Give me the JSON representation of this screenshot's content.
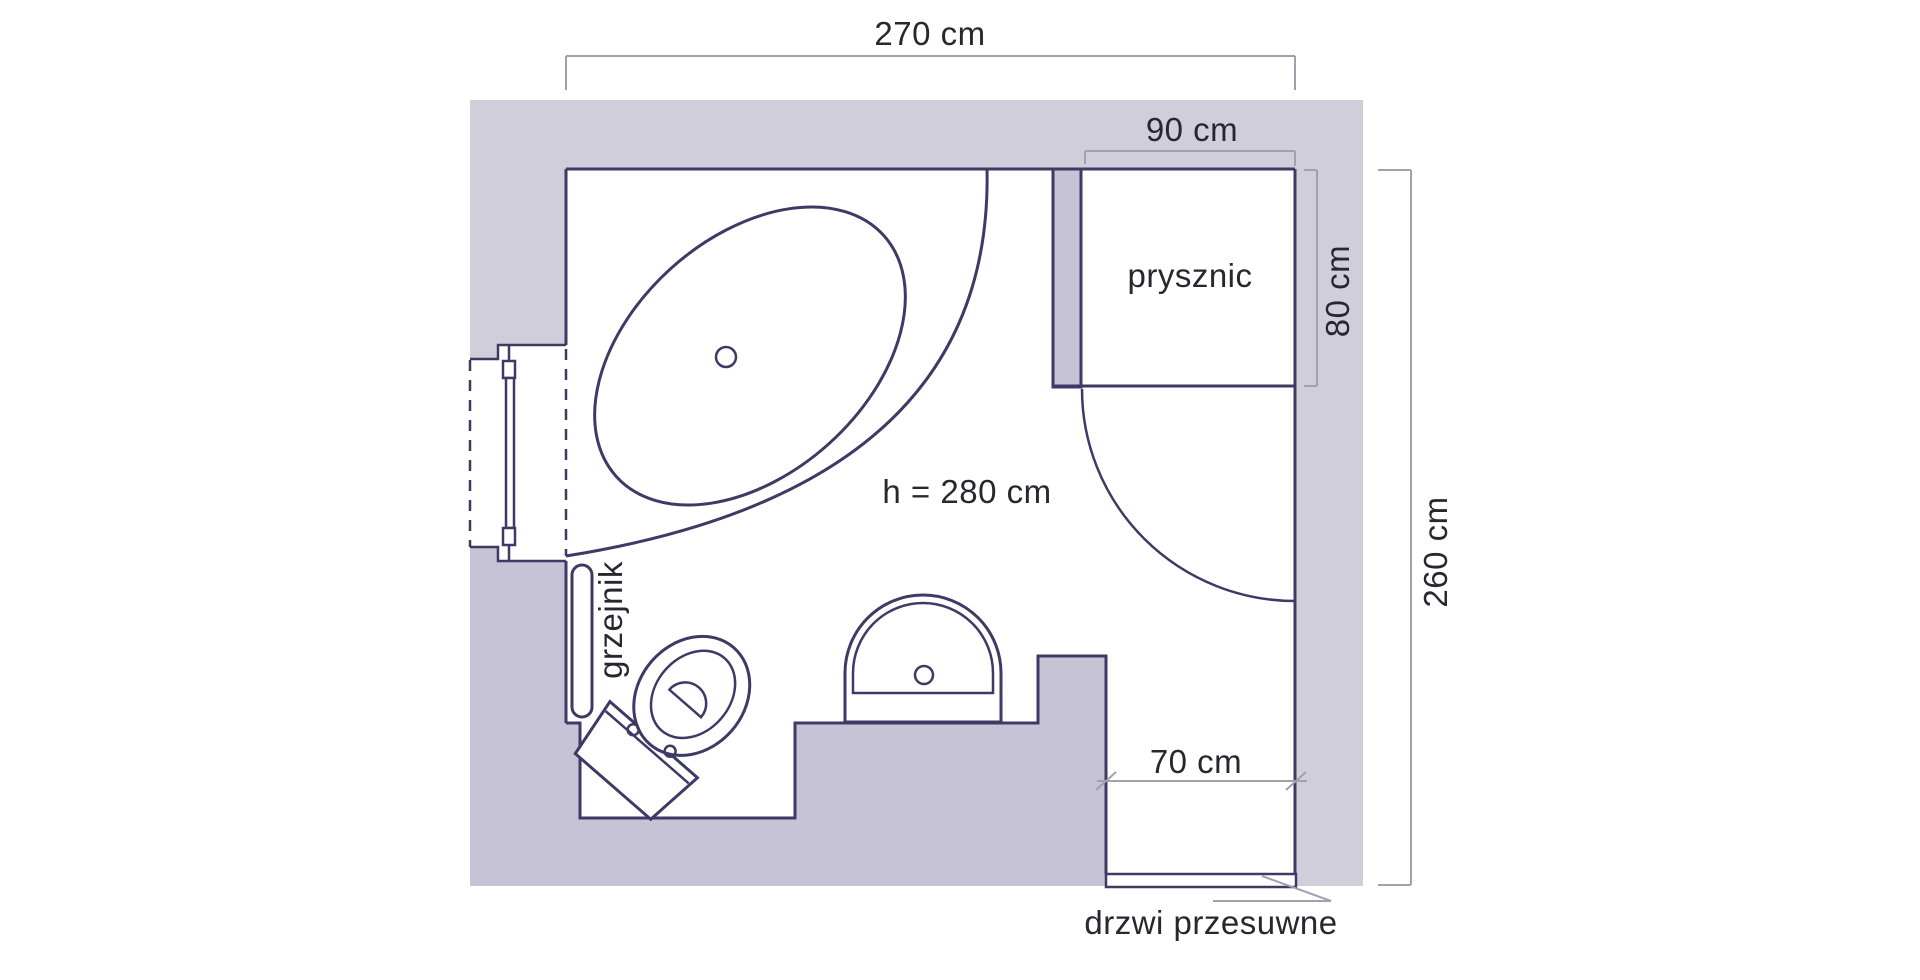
{
  "floor_plan": {
    "dimensions": {
      "room_width": "270 cm",
      "shower_width": "90 cm",
      "shower_depth": "80 cm",
      "room_depth": "260 cm",
      "door_width": "70 cm",
      "ceiling_height": "h = 280 cm"
    },
    "labels": {
      "shower": "prysznic",
      "radiator": "grzejnik",
      "sliding_door": "drzwi przesuwne"
    },
    "colors": {
      "wall_light": "#d1cedc",
      "wall_dark": "#c6c3d6",
      "outline": "#3e3a66",
      "dimension_line": "#a3a0ae",
      "text": "#28272f",
      "background": "#ffffff"
    }
  }
}
